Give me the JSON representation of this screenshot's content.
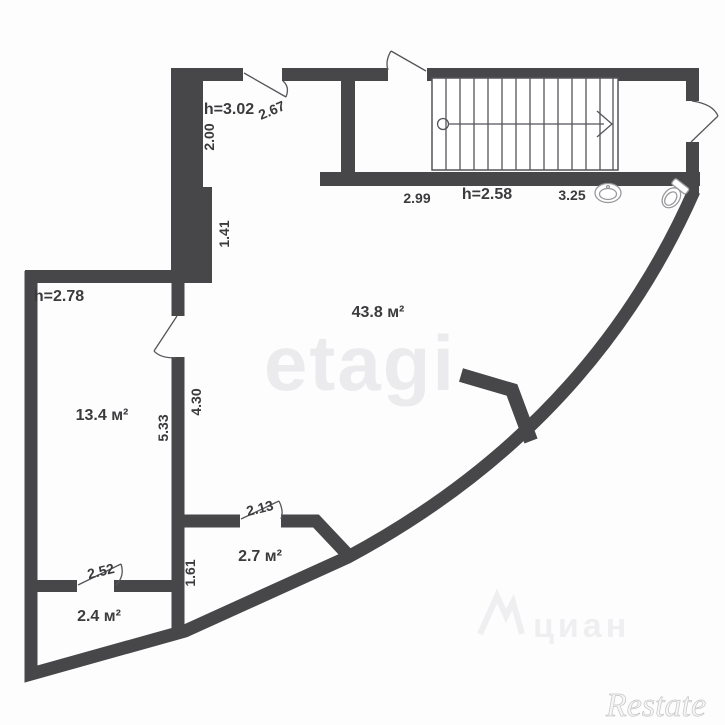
{
  "colors": {
    "bg": "#fdfdfd",
    "wall-color": "#47474a",
    "line-color": "#55555a",
    "text-color": "#3b3b3e",
    "fixture-color": "#9a9a9e",
    "wm-etagi": "#ebebed",
    "wm-cian": "#efeff1",
    "wm-restate-fill": "#f6f6f6",
    "wm-restate-stroke": "#c6c6c9"
  },
  "floorplan": {
    "rooms": {
      "main": {
        "area": "43.8 м²",
        "height": "h=3.02"
      },
      "left": {
        "area": "13.4 м²",
        "height": "h=2.78"
      },
      "stair_hall": {
        "height": "h=2.58"
      },
      "small_mid": {
        "area": "2.7 м²"
      },
      "small_bottom": {
        "area": "2.4 м²"
      }
    },
    "dimensions": {
      "d267": "2.67",
      "d200": "2.00",
      "d141": "1.41",
      "d299": "2.99",
      "d325": "3.25",
      "d533": "5.33",
      "d430": "4.30",
      "d213": "2.13",
      "d161": "1.61",
      "d252": "2.52"
    }
  },
  "watermarks": {
    "etagi": "etagi",
    "cian": "циан",
    "restate": "Restate"
  }
}
